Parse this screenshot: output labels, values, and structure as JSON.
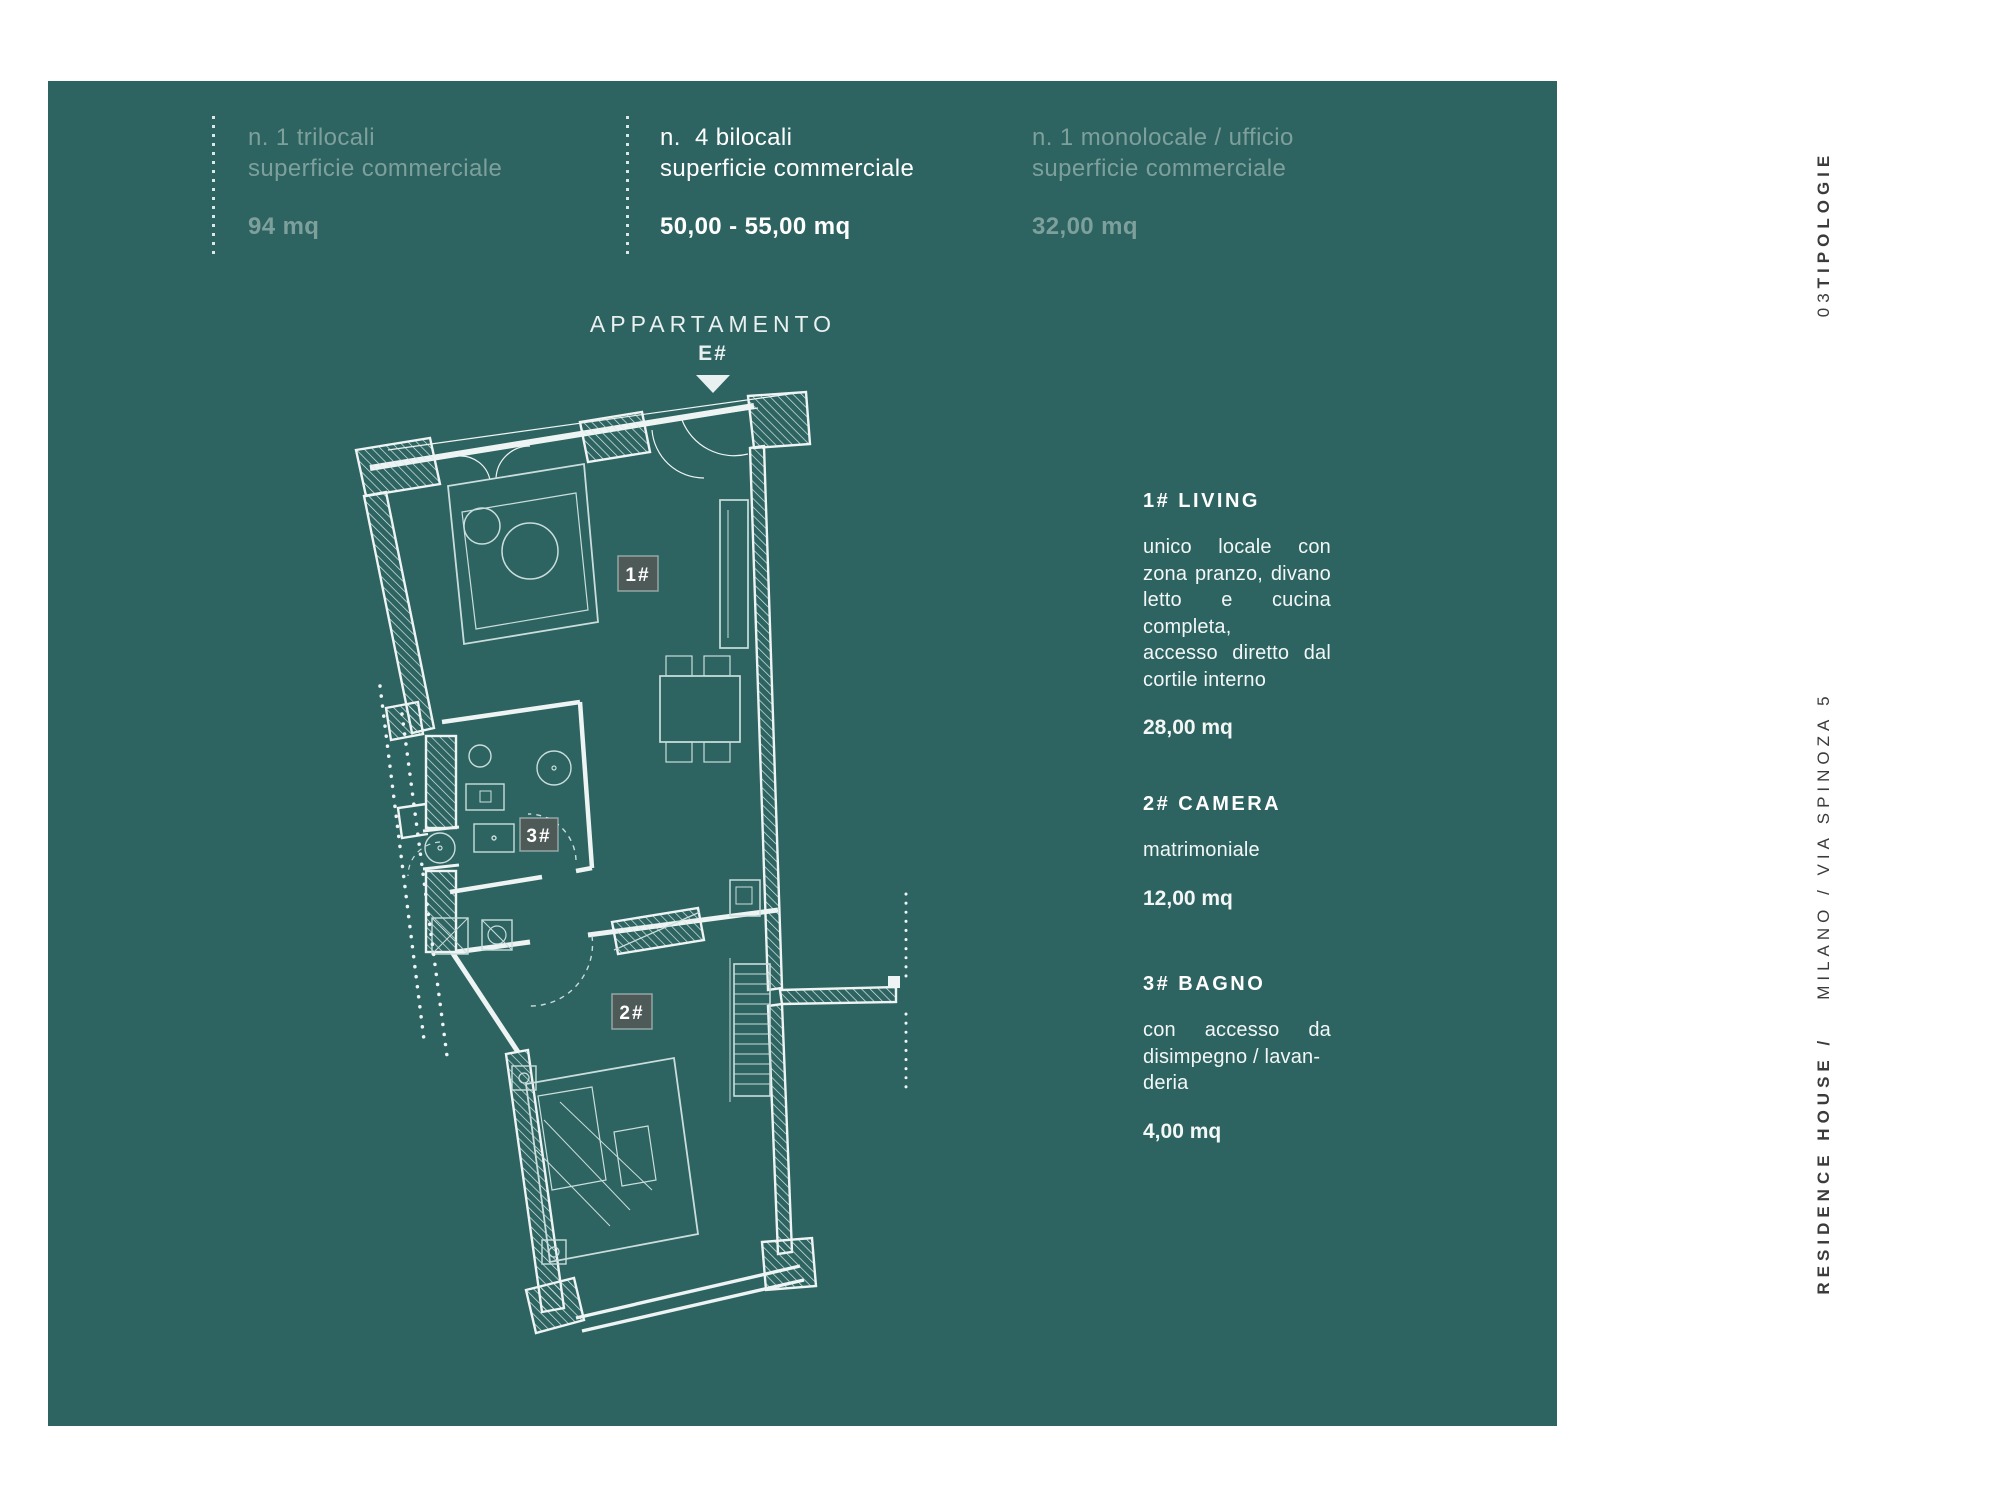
{
  "colors": {
    "panel_bg": "#2d6360",
    "muted_text": "#7ea09c",
    "white_text": "#ffffff",
    "margin_ink": "#3b3b3b",
    "plan_line": "#edf4f3",
    "chip_bg": "#4e5a57"
  },
  "header": {
    "columns": [
      {
        "line1": "n. 1 trilocali",
        "line2": "superficie commerciale",
        "value": "94 mq"
      },
      {
        "line1": "n.  4 bilocali",
        "line2": "superficie commerciale",
        "value": "50,00 - 55,00 mq"
      },
      {
        "line1": "n. 1 monolocale / ufficio",
        "line2": "superficie commerciale",
        "value": "32,00 mq"
      }
    ]
  },
  "plan": {
    "title": "APPARTAMENTO",
    "unit": "E#",
    "labels": {
      "living": "1#",
      "camera": "2#",
      "bagno": "3#"
    }
  },
  "details": {
    "sections": [
      {
        "title": "1# LIVING",
        "body": "unico locale con zona pranzo, divano letto e cucina completa,\naccesso diretto dal cortile interno",
        "area": "28,00 mq"
      },
      {
        "title": "2# CAMERA",
        "body": "matrimoniale",
        "area": "12,00 mq"
      },
      {
        "title": "3# BAGNO",
        "body": "con accesso da disimpegno / lavan-\nderia",
        "area": "4,00 mq"
      }
    ]
  },
  "margin": {
    "section_number": "03 ",
    "section_label": "TIPOLOGIE",
    "brand_bold": "RESIDENCE HOUSE /",
    "brand_regular": "MILANO / VIA SPINOZA 5"
  }
}
